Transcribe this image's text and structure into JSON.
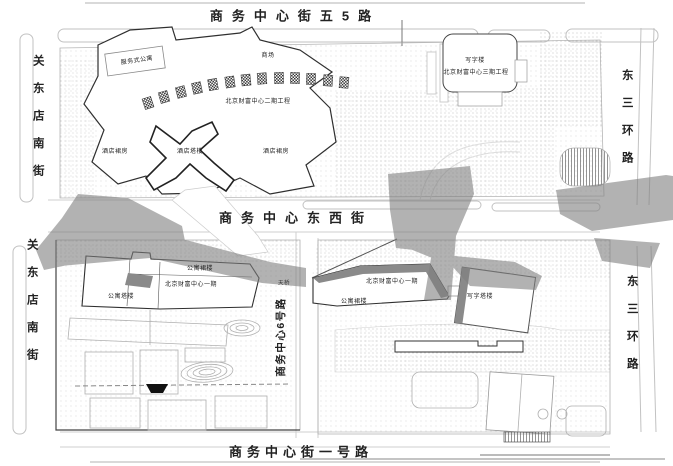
{
  "map": {
    "streets": {
      "top": "商务中心街五5路",
      "middle": "商务中心东西街",
      "bottom": "商务中心街一号路",
      "left_upper": "关东店南街",
      "left_lower": "关东店南街",
      "right_upper": "东三环路",
      "right_lower": "东三环路",
      "center_vertical": "商务中心6号路",
      "footbridge": "天桥"
    },
    "north_block": {
      "serviced_apartment": "服务式公寓",
      "mall": "商场",
      "phase2": "北京财富中心二期工程",
      "hotel_podium_left": "酒店裙房",
      "hotel_tower": "酒店塔楼",
      "hotel_podium_right": "酒店裙房",
      "office": "写字楼",
      "phase3": "北京财富中心三期工程"
    },
    "southwest_block": {
      "apartment_podium": "公寓裙楼",
      "phase1": "北京财富中心一期",
      "apartment_tower": "公寓塔楼"
    },
    "southeast_block": {
      "phase1": "北京财富中心一期",
      "apartment_podium": "公寓裙楼",
      "office_tower": "写字塔楼"
    },
    "colors": {
      "paper": "#ffffff",
      "building_stroke": "#2f2f2f",
      "light_line": "#c2c2c2",
      "shadow": "#7e7e7e",
      "texture_dot": "#9a9a9a"
    }
  }
}
